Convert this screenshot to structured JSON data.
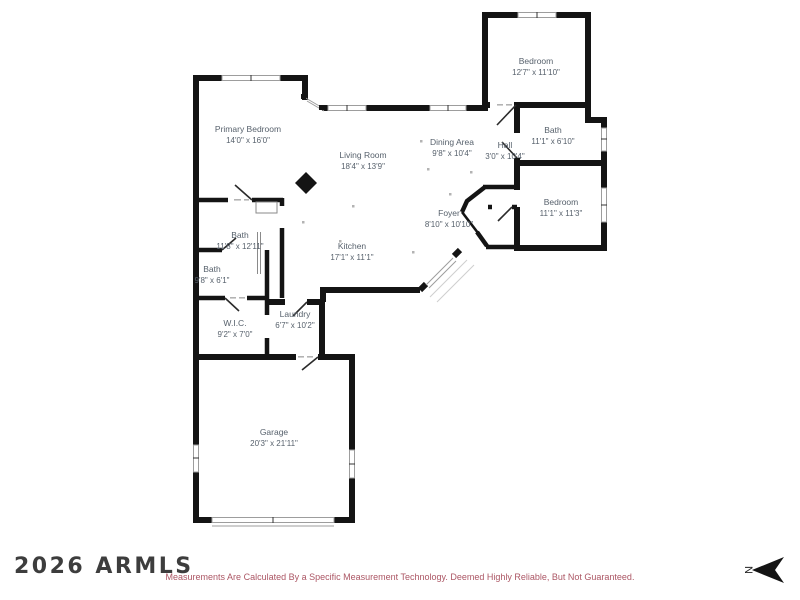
{
  "floorplan": {
    "rooms": {
      "bedroom_top": {
        "name": "Bedroom",
        "dims": "12'7\" x 11'10\""
      },
      "bath_hall": {
        "name": "Bath",
        "dims": "11'1\" x 6'10\""
      },
      "bedroom_right": {
        "name": "Bedroom",
        "dims": "11'1\" x 11'3\""
      },
      "primary_bedroom": {
        "name": "Primary Bedroom",
        "dims": "14'0\" x 16'0\""
      },
      "living_room": {
        "name": "Living Room",
        "dims": "18'4\" x 13'9\""
      },
      "dining_area": {
        "name": "Dining Area",
        "dims": "9'8\" x 10'4\""
      },
      "hall": {
        "name": "Hall",
        "dims": "3'0\" x 10'4\""
      },
      "foyer": {
        "name": "Foyer",
        "dims": "8'10\" x 10'10\""
      },
      "bath_main": {
        "name": "Bath",
        "dims": "11'8\" x 12'11\""
      },
      "bath_small": {
        "name": "Bath",
        "dims": "9'8\" x 6'1\""
      },
      "kitchen": {
        "name": "Kitchen",
        "dims": "17'1\" x 11'1\""
      },
      "wic": {
        "name": "W.I.C.",
        "dims": "9'2\" x 7'0\""
      },
      "laundry": {
        "name": "Laundry",
        "dims": "6'7\" x 10'2\""
      },
      "garage": {
        "name": "Garage",
        "dims": "20'3\" x 21'11\""
      }
    },
    "compass_label": "N"
  },
  "footer": {
    "watermark": "2026 ARMLS",
    "disclaimer": "Measurements Are Calculated By a Specific Measurement Technology. Deemed Highly Reliable, But Not Guaranteed."
  },
  "colors": {
    "wall": "#141414",
    "room_label": "#57616c",
    "window": "#9d9d9d",
    "watermark": "#3d3d3d",
    "disclaimer": "#ac5765",
    "background": "#ffffff"
  }
}
